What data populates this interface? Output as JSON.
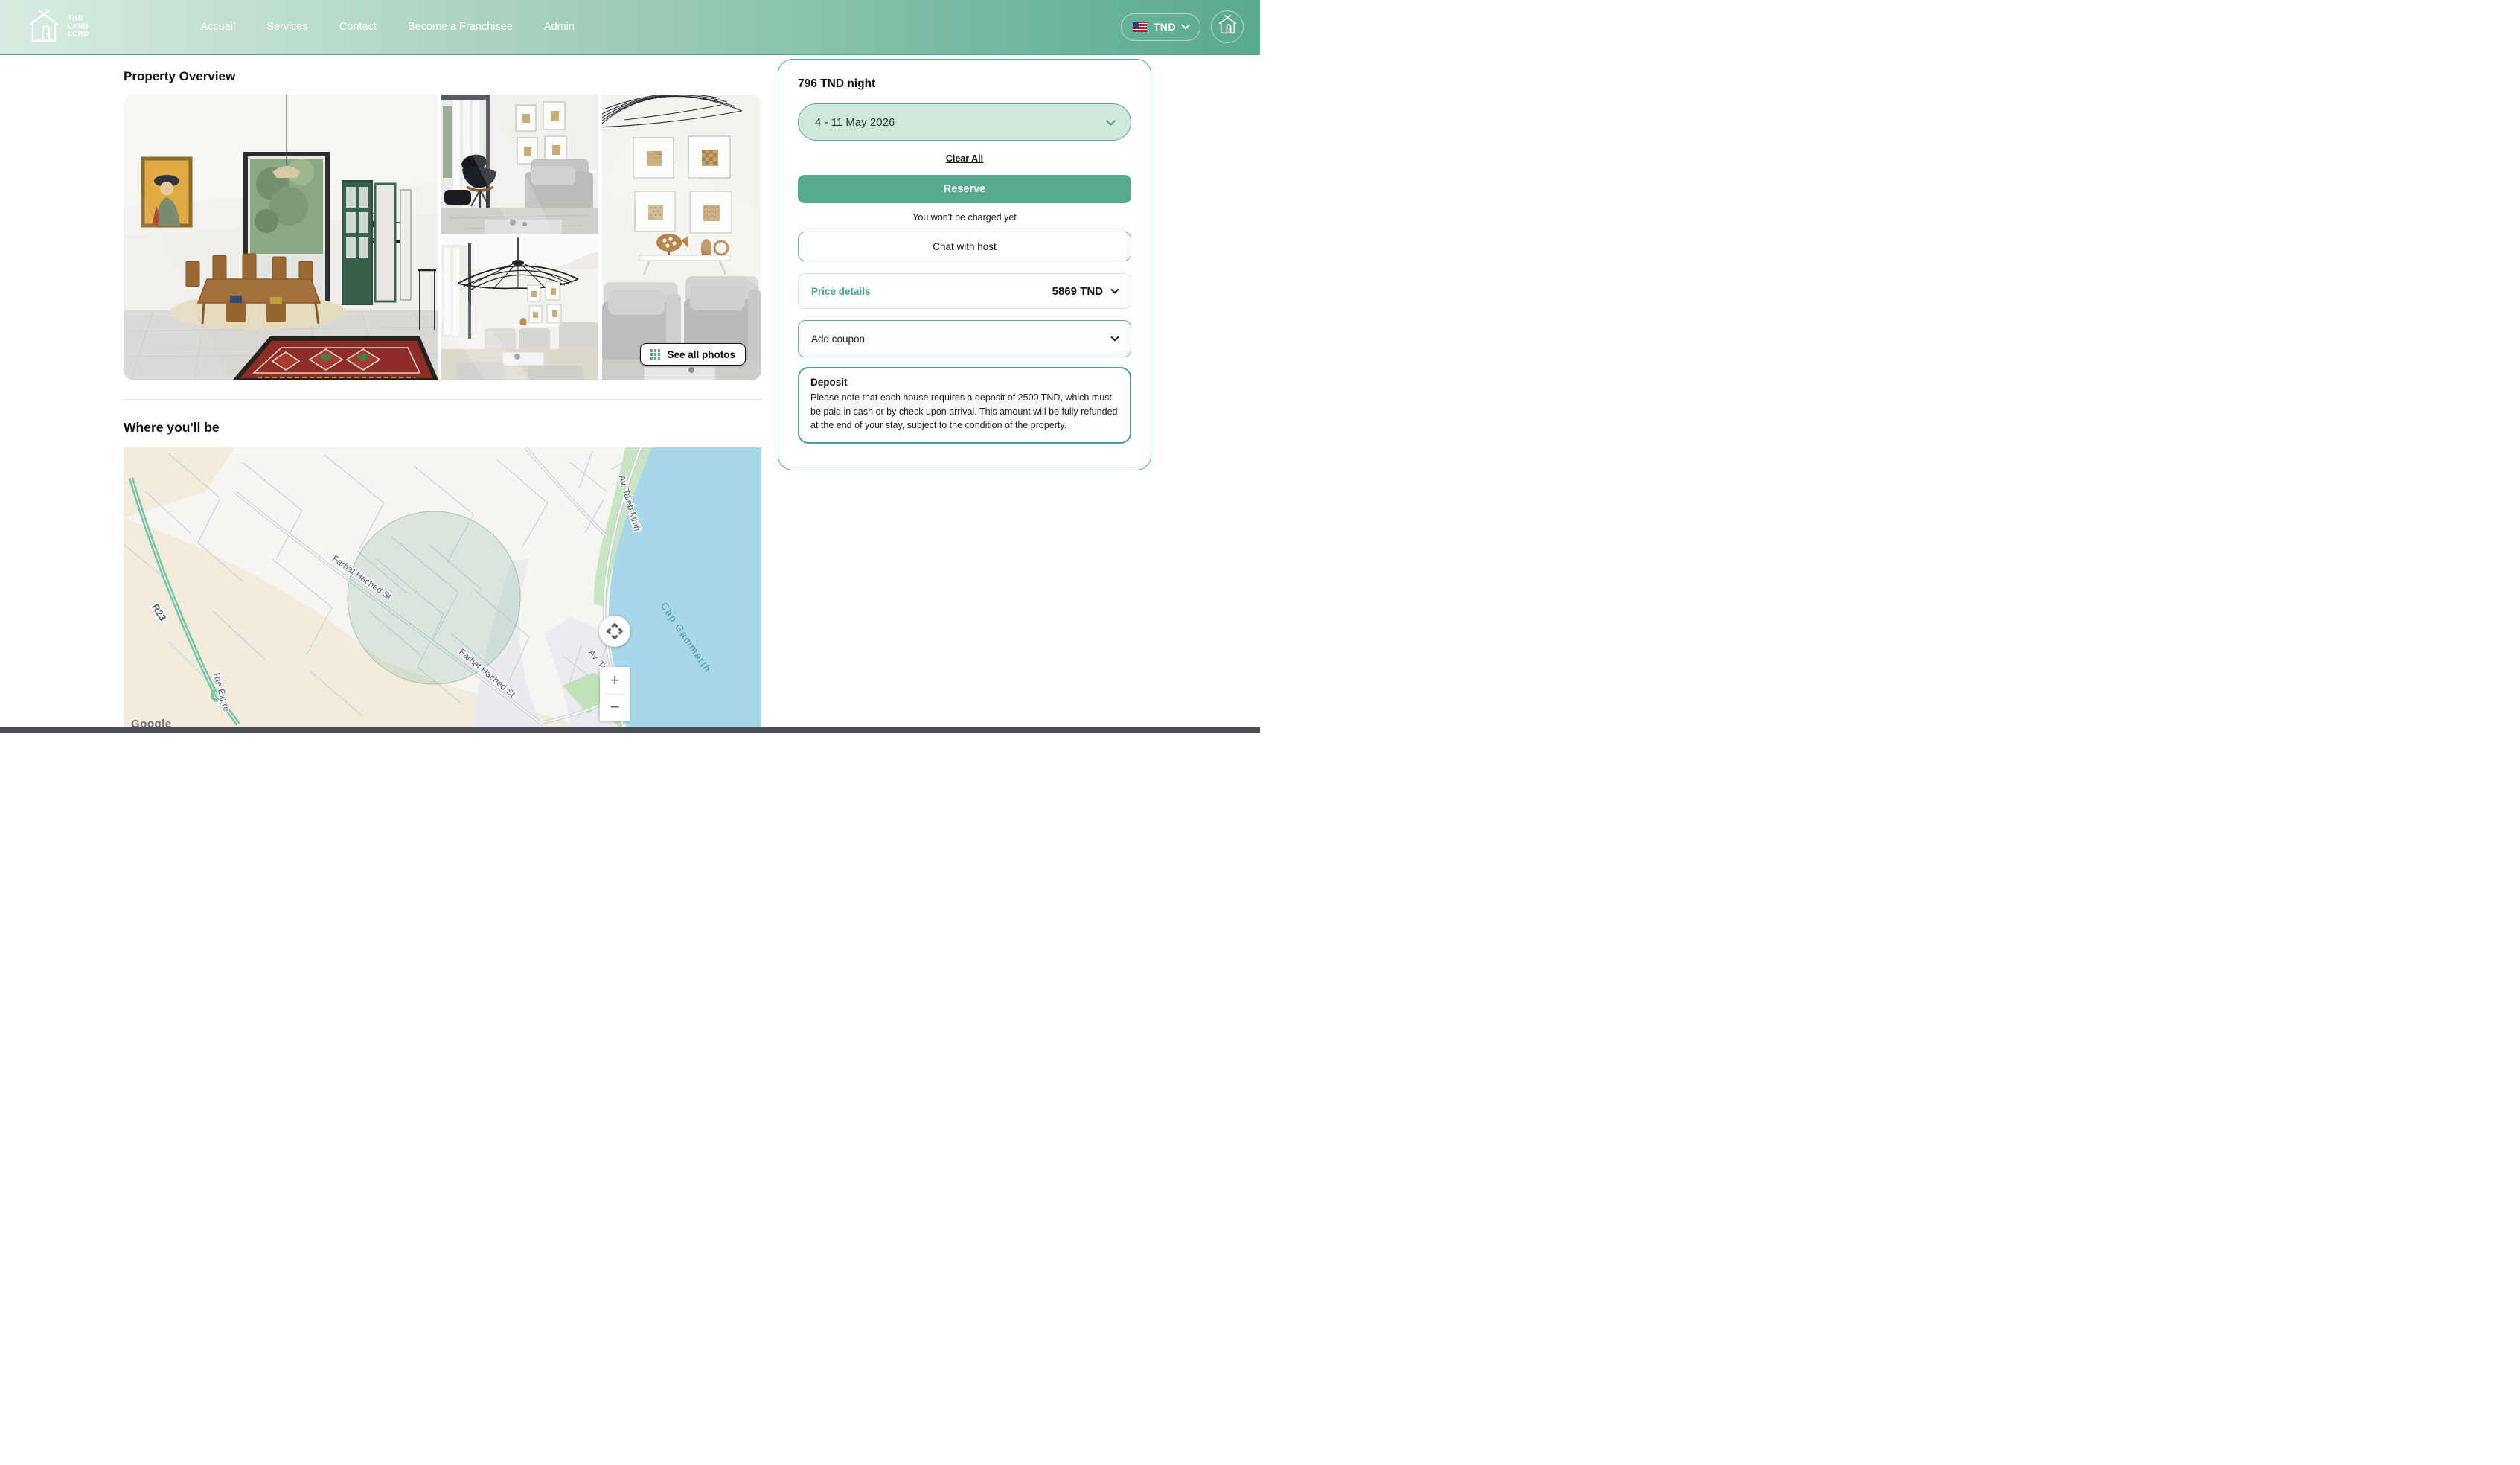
{
  "brand": {
    "line1": "THE",
    "line2": "LAND",
    "line3": "LORD"
  },
  "nav": {
    "items": [
      {
        "label": "Accueil"
      },
      {
        "label": "Services"
      },
      {
        "label": "Contact"
      },
      {
        "label": "Become a Franchisee"
      },
      {
        "label": "Admin"
      }
    ]
  },
  "header": {
    "currency": "TND"
  },
  "overview": {
    "title": "Property Overview",
    "see_all": "See all photos"
  },
  "location": {
    "title": "Where you'll be"
  },
  "booking": {
    "price_per_night": "796 TND night",
    "date_range": "4 - 11 May 2026",
    "clear_all": "Clear All",
    "reserve": "Reserve",
    "no_charge_note": "You won't be charged yet",
    "chat": "Chat with host",
    "price_details_label": "Price details",
    "price_total": "5869 TND",
    "add_coupon": "Add coupon",
    "deposit_title": "Deposit",
    "deposit_text": "Please note that each house requires a deposit of 2500 TND, which must be paid in cash or by check upon arrival. This amount will be fully refunded at the end of your stay, subject to the condition of the property."
  },
  "map": {
    "street_label_1": "Farhat Hached St",
    "street_label_2": "Farhat Hached St",
    "avenue_label_1": "Av. Taieb Mhiri",
    "avenue_label_2": "Av. Taieb Mhiri",
    "water_label": "Cap Gammarth",
    "route_badge": "R23",
    "route_label": "Rte Expre",
    "google": "Google",
    "zoom_in": "+",
    "zoom_out": "−"
  },
  "icons": {
    "logo": "house-logo-icon",
    "flag": "us-flag-icon",
    "currency_chevron": "chevron-down-icon",
    "home_button": "house-icon",
    "see_all_grid": "grid-icon",
    "map_pan": "pan-arrows-icon",
    "zoom_in": "plus-icon",
    "zoom_out": "minus-icon"
  },
  "colors": {
    "accent_green": "#57AB8E",
    "light_mint": "#CFE8DC",
    "header_gradient_start": "#D7ECE2",
    "header_gradient_end": "#58AA8F",
    "deposit_border": "#4DA287",
    "water_blue": "#A7D7E8",
    "footer_bar": "#4B4E54"
  }
}
